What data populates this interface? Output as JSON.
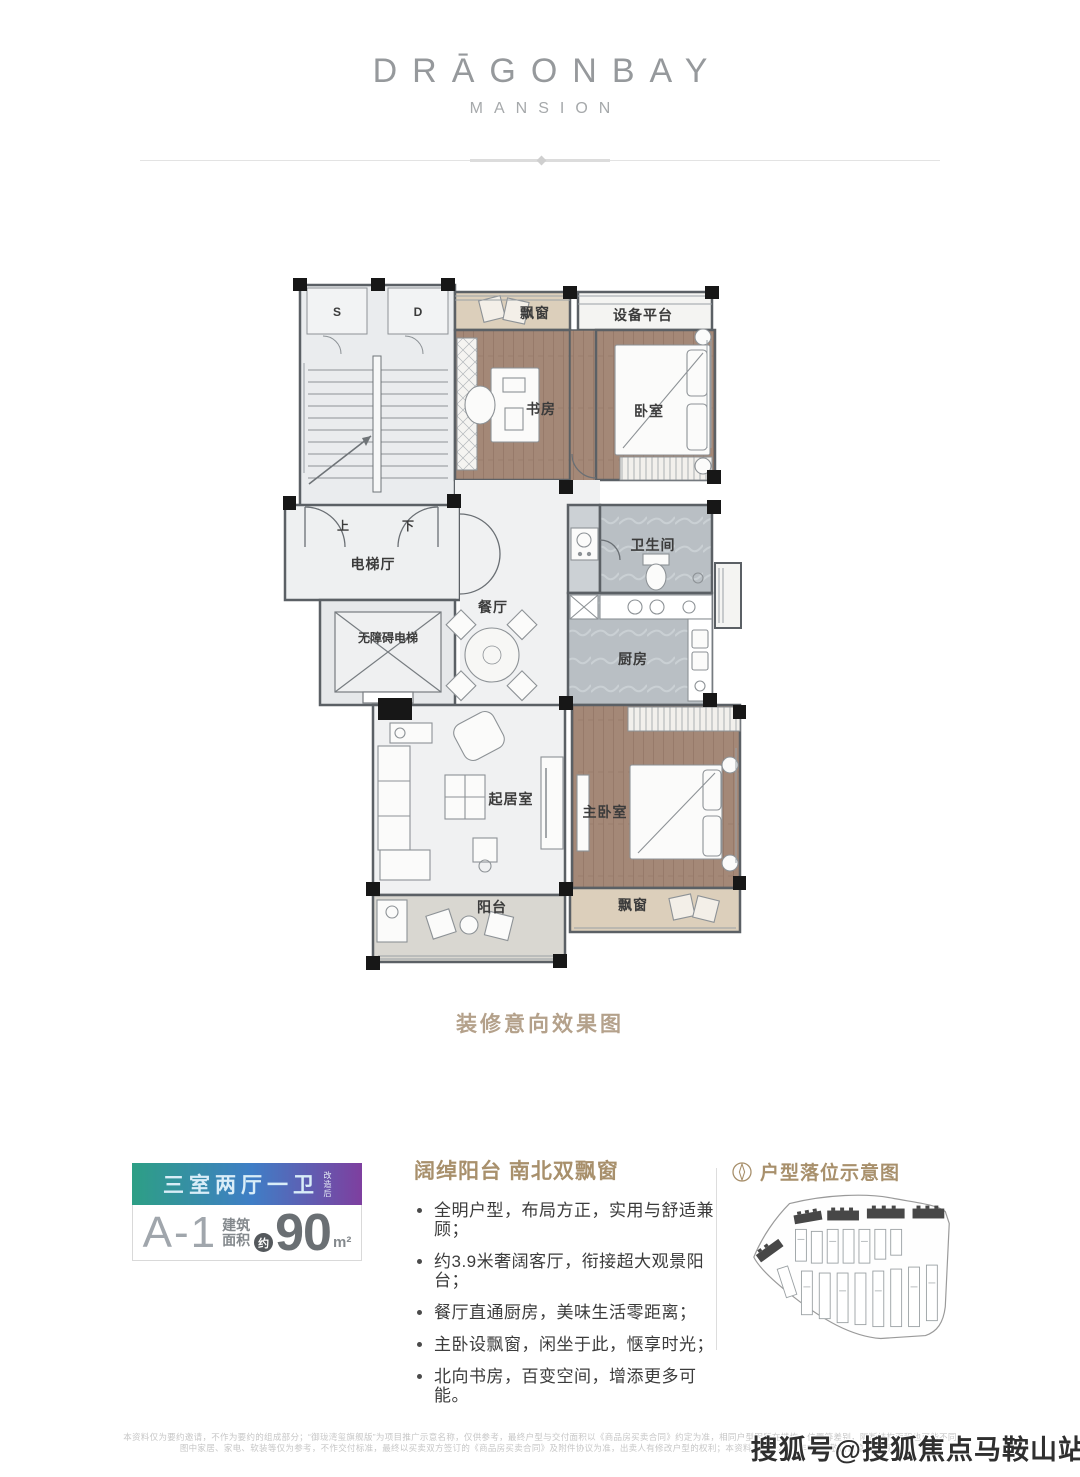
{
  "brand": {
    "title": "DRĀGONBAY",
    "subtitle": "MANSION"
  },
  "floorplan": {
    "caption": "装修意向效果图",
    "rooms": {
      "shaft_s": "S",
      "shaft_d": "D",
      "bay_top": "飘窗",
      "equipment": "设备平台",
      "study": "书房",
      "bedroom": "卧室",
      "up": "上",
      "down": "下",
      "elevator_hall": "电梯厅",
      "accessible_elevator": "无障碍电梯",
      "dining": "餐厅",
      "bathroom": "卫生间",
      "kitchen": "厨房",
      "living": "起居室",
      "master_bedroom": "主卧室",
      "balcony": "阳台",
      "bay_bottom": "飘窗"
    }
  },
  "info": {
    "badge": {
      "layout_label": "三室两厅一卫",
      "layout_note": "改造后",
      "unit_code": "A-1",
      "area_label_top": "建筑",
      "area_label_bottom": "面积",
      "approx_label": "约",
      "area_value": "90",
      "area_unit": "m²"
    },
    "features": {
      "heading": "阔绰阳台 南北双飘窗",
      "bullets": [
        "全明户型，布局方正，实用与舒适兼顾；",
        "约3.9米奢阔客厅，衔接超大观景阳台；",
        "餐厅直通厨房，美味生活零距离；",
        "主卧设飘窗，闲坐于此，惬享时光；",
        "北向书房，百变空间，增添更多可能。"
      ]
    },
    "siteplan": {
      "heading": "户型落位示意图"
    }
  },
  "footer": {
    "disclaimer_line1": "本资料仅为要约邀请，不作为要约的组成部分；“御珑湾玺旗舰版”为项目推广示意名称，仅供参考，最终户型与交付面积以《商品房买卖合同》约定为准，相同户型因所在楼栋、位置等差别，隔断结构面积也可能不同",
    "disclaimer_line2": "图中家居、家电、软装等仅为参考，不作交付标准，最终以买卖双方签订的《商品房买卖合同》及附件协议为准，出卖人有修改户型的权利；本资料发布于2020年7月，敬请留意最新资料",
    "watermark": "搜狐号@搜狐焦点马鞍山站"
  },
  "colors": {
    "accent_tan": "#a8906c",
    "badge_gradient_start": "#2d9f85",
    "badge_gradient_mid": "#3f7ec6",
    "badge_gradient_end": "#7e3f9f",
    "wood_floor": "#a48877",
    "marble_floor": "#b9bfc4",
    "bay_window_fill": "#dccfbb"
  }
}
